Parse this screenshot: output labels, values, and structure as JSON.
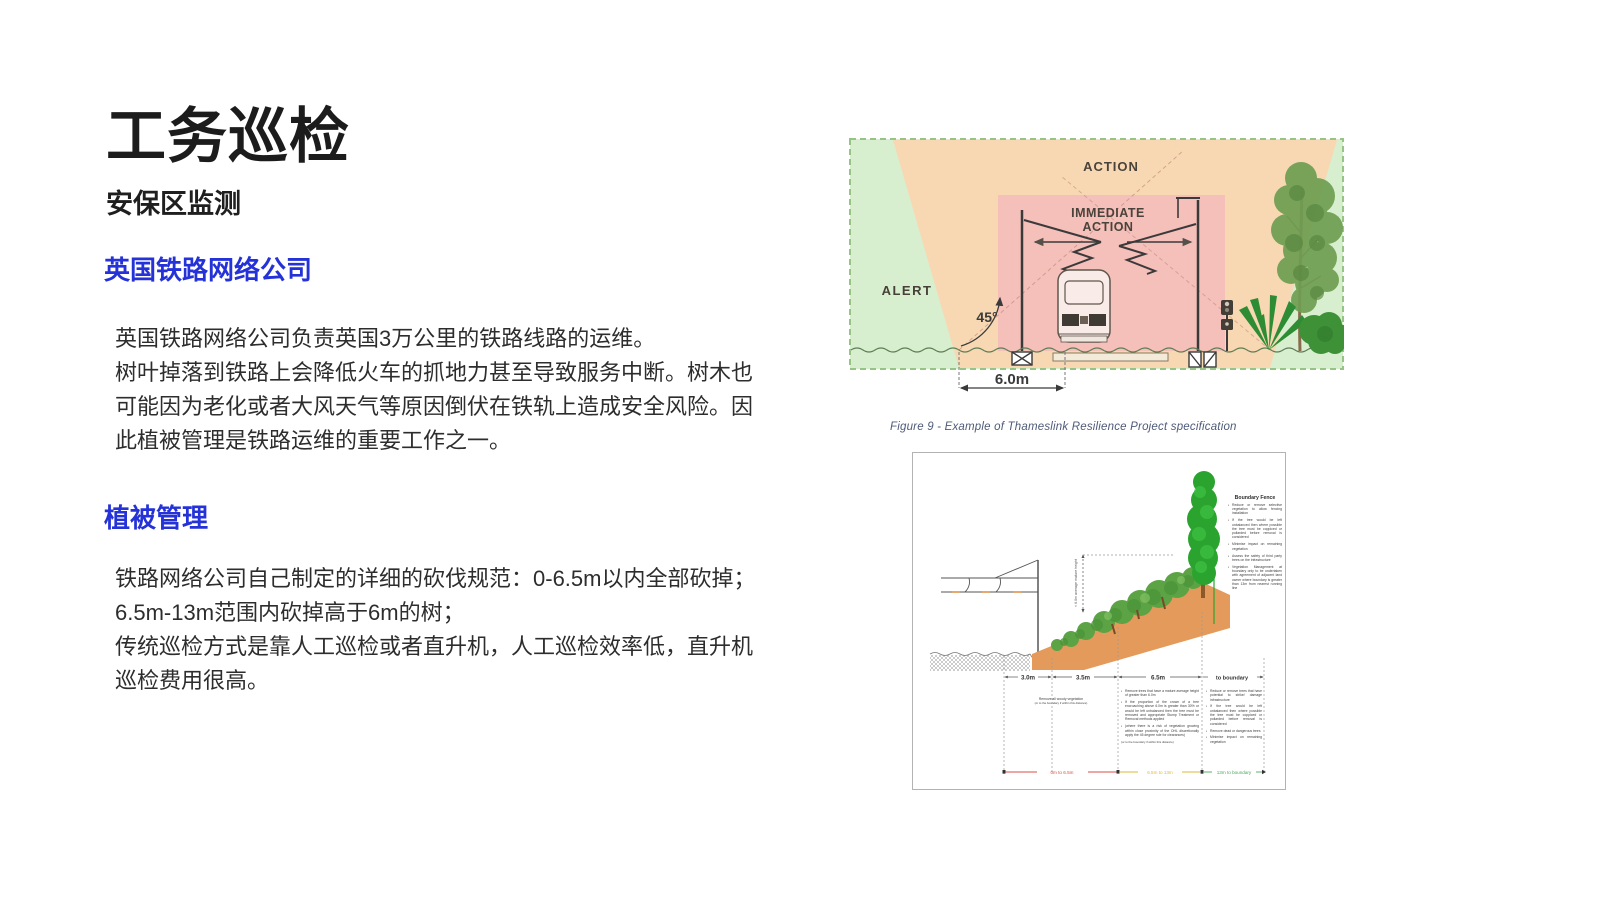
{
  "theme": {
    "accent_blue": "#2432d8",
    "text_dark": "#1c1c1c"
  },
  "slide": {
    "title": "工务巡检",
    "subtitle": "安保区监测",
    "sections": [
      {
        "heading": "英国铁路网络公司",
        "lines": [
          "英国铁路网络公司负责英国3万公里的铁路线路的运维。",
          "树叶掉落到铁路上会降低火车的抓地力甚至导致服务中断。树木也",
          "可能因为老化或者大风天气等原因倒伏在铁轨上造成安全风险。因",
          "此植被管理是铁路运维的重要工作之一。"
        ]
      },
      {
        "heading": "植被管理",
        "lines": [
          "铁路网络公司自己制定的详细的砍伐规范：0-6.5m以内全部砍掉；",
          "6.5m-13m范围内砍掉高于6m的树；",
          "传统巡检方式是靠人工巡检或者直升机，人工巡检效率低，直升机",
          "巡检费用很高。"
        ]
      }
    ]
  },
  "figure_caption": "Figure 9 - Example of Thameslink Resilience Project specification",
  "clearance_diagram": {
    "zone_action": "ACTION",
    "zone_immediate_line1": "IMMEDIATE",
    "zone_immediate_line2": "ACTION",
    "zone_alert": "ALERT",
    "angle_label": "45°",
    "dimension_label": "6.0m",
    "colors": {
      "alert": "#d8efcf",
      "action": "#f7d8b3",
      "immediate": "#f5bfba"
    }
  },
  "spec_diagram": {
    "slope_height_label": "< 6.0m average mature height",
    "columns": [
      "3.0m",
      "3.5m",
      "6.5m",
      "to boundary"
    ],
    "left_note_line1": "Remove all woody vegetation",
    "left_note_line2": "(or to the boundary if within this distance)",
    "mid_bullets": [
      "Remove trees that have a mature average height of greater than 6.0m",
      "If the proportion of the crown of a tree encroaching above 6.0m is greater than 30% or would be left unbalanced then the tree must be removed and appropriate Stump Treatment or Removal methods applied",
      "(where there is a risk of vegetation growing within close proximity of the OHL discretionally apply the 45 degree rule for clearances)"
    ],
    "mid_note": "(or to the boundary if within this distance)",
    "right_bullets": [
      "Reduce or remove trees that have potential to strike/ damage infrastructure",
      "If the tree would be left unbalanced then where possible the tree must be coppiced or pollarded before removal is considered",
      "Remove dead or dangerous trees",
      "Minimise impact on remaining vegetation"
    ],
    "boundary_fence": {
      "heading": "Boundary Fence",
      "bullets": [
        "Reduce or remove selective vegetation to allow fencing installation",
        "If the tree would be left unbalanced then where possible the tree must be coppiced or pollarded before removal is considered",
        "Minimise impact on remaining vegetation",
        "Assess the safety of third party trees on the infrastructure",
        "Vegetation Management at boundary only to be undertaken with agreement of adjacent land owner where boundary is greater than 13m from nearest running line"
      ]
    },
    "zones": [
      {
        "label": "0m to 6.5m",
        "color": "#d94f43"
      },
      {
        "label": "6.5m to 13m",
        "color": "#dfb93a"
      },
      {
        "label": "13m to boundary",
        "color": "#4aa85c"
      }
    ]
  }
}
